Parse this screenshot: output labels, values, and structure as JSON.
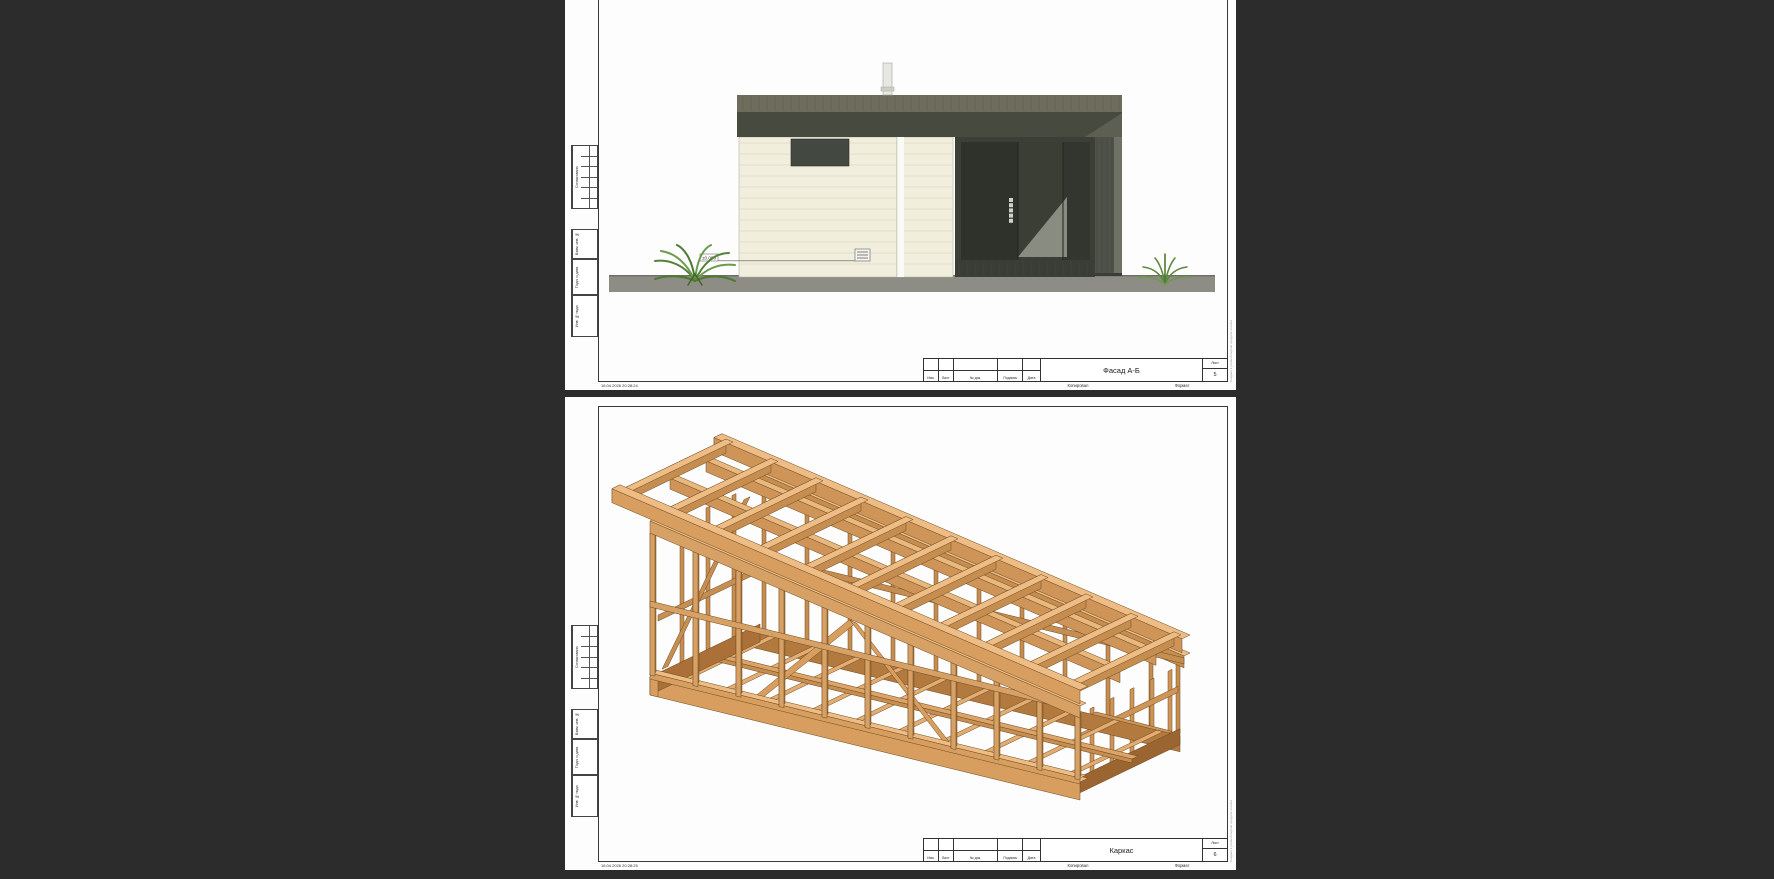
{
  "background_color": "#2c2c2c",
  "watermark": "Создано в учебной версии продукта Autodesk",
  "sheets": [
    {
      "title": "Фасад А-Б",
      "sheet_label": "Лист",
      "sheet_number": "5",
      "stamp_columns": [
        "Изм.",
        "Лист",
        "№ док.",
        "Подпись",
        "Дата"
      ],
      "side_labels": [
        "Согласовано",
        "Взам. инв. №",
        "Подп. и дата",
        "Инв. № подл."
      ],
      "footer": {
        "datestamp": "16.04.2026 20:28:24",
        "copied": "Копировал",
        "format": "Формат"
      },
      "level_mark": "±0.000"
    },
    {
      "title": "Каркас",
      "sheet_label": "Лист",
      "sheet_number": "6",
      "stamp_columns": [
        "Изм.",
        "Лист",
        "№ док.",
        "Подпись",
        "Дата"
      ],
      "side_labels": [
        "Согласовано",
        "Взам. инв. №",
        "Подп. и дата",
        "Инв. № подл."
      ],
      "footer": {
        "datestamp": "16.04.2026 20:28:25",
        "copied": "Копировал",
        "format": "Формат"
      }
    }
  ],
  "colors": {
    "paper": "#fdfdfd",
    "frame_line": "#3a3a3a",
    "siding_cream": "#f1eedd",
    "roof_band": "#6e6c5d",
    "fascia_dark": "#474a3f",
    "glass_dark": "#31342c",
    "ground_gray": "#8d8d86",
    "wood_light": "#eebd85",
    "wood_mid": "#d79e60",
    "wood_dark": "#a06a34",
    "plant_green": "#5e8038"
  }
}
